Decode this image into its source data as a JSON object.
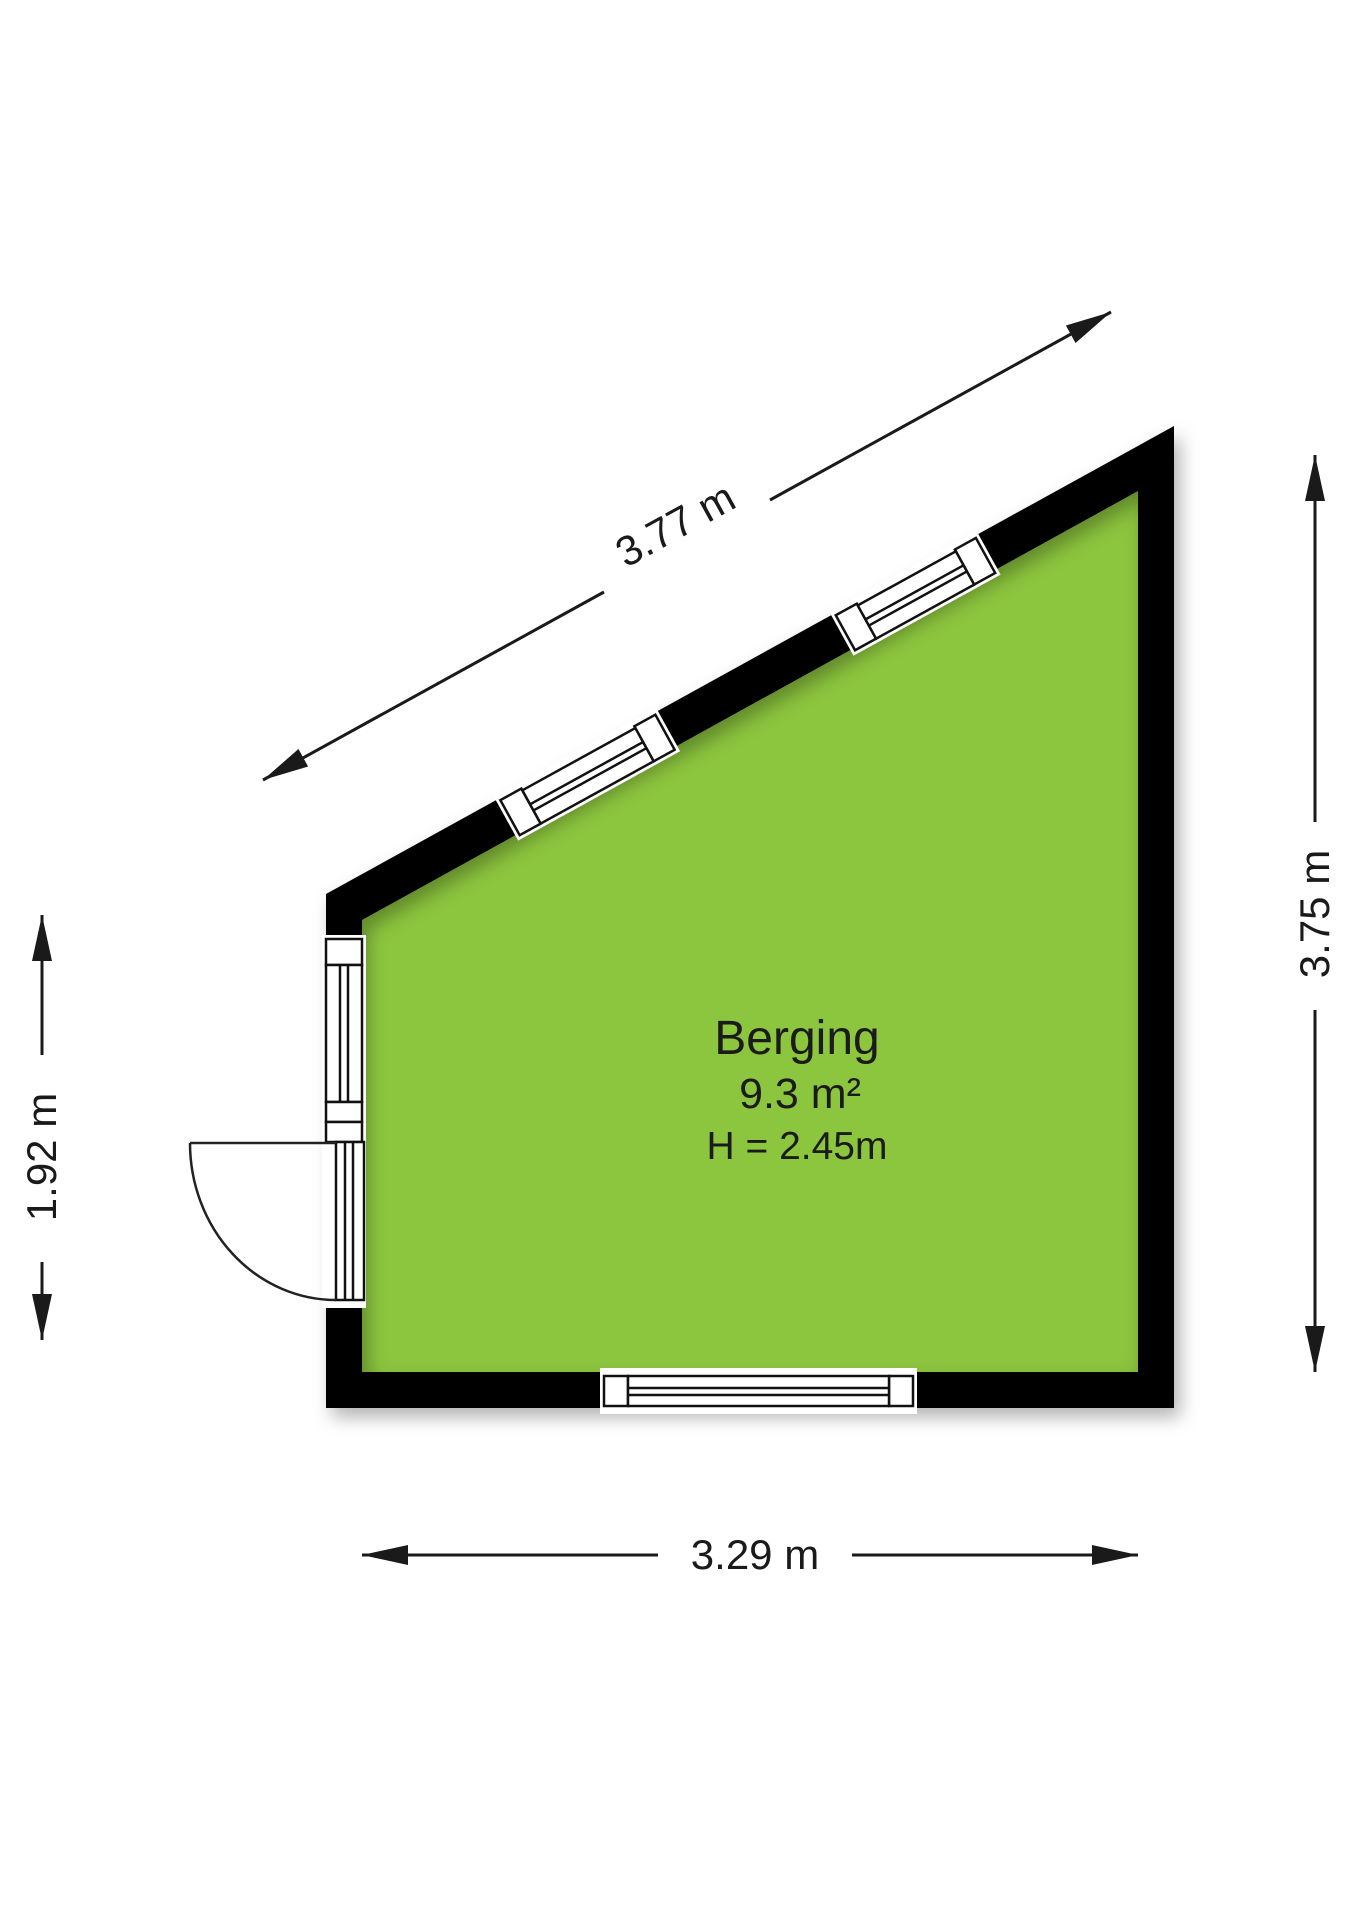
{
  "floorplan": {
    "room": {
      "name": "Berging",
      "area": "9.3 m²",
      "ceiling_height": "H = 2.45m"
    },
    "dimensions": {
      "top_diagonal": "3.77 m",
      "right": "3.75 m",
      "left": "1.92 m",
      "bottom": "3.29 m"
    },
    "colors": {
      "floor": "#8CC53E",
      "wall": "#000000",
      "dimension_ink": "#1A1A1A",
      "background": "#FFFFFF"
    }
  }
}
